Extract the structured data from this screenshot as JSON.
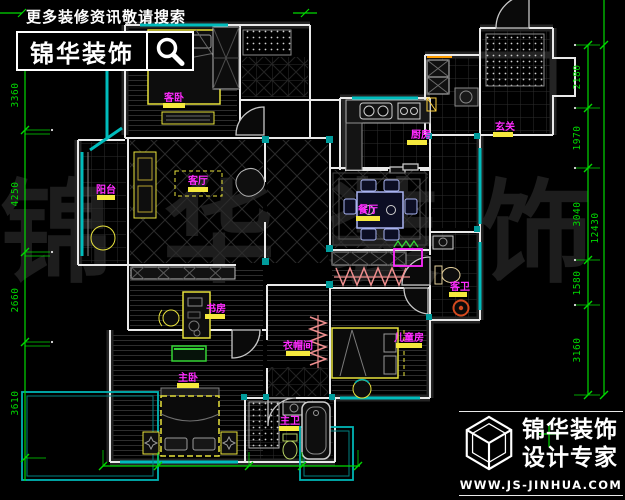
{
  "search_banner": {
    "tagline": "更多装修资讯敬请搜索",
    "brand": "锦华装饰",
    "icon": "search-icon"
  },
  "brand_footer": {
    "brand": "锦华装饰",
    "tagline": "设计专家",
    "website": "WWW.JS-JINHUA.COM",
    "icon": "cube-logo-icon"
  },
  "watermark": {
    "chars": [
      "锦",
      "华",
      "装",
      "饰"
    ]
  },
  "rooms": {
    "bedroom_top": {
      "label": "客卧"
    },
    "living": {
      "label": "客厅"
    },
    "balcony": {
      "label": "阳台"
    },
    "dining": {
      "label": "餐厅"
    },
    "kitchen": {
      "label": "厨房"
    },
    "entrance": {
      "label": "玄关"
    },
    "study": {
      "label": "书房"
    },
    "master": {
      "label": "主卧"
    },
    "closet": {
      "label": "衣帽间"
    },
    "bath_right": {
      "label": "客卫"
    },
    "bedroom_child": {
      "label": "儿童房"
    },
    "master_bath": {
      "label": "主卫"
    }
  },
  "dimensions": {
    "left": [
      "3360",
      "4250",
      "2660",
      "3610"
    ],
    "right": [
      "2180",
      "1970",
      "3040",
      "1580",
      "3160"
    ],
    "right_total": "12430"
  },
  "colors": {
    "wall": "#e9e9e9",
    "window": "#00bcbc",
    "furniture": "#e8e23c",
    "label": "#ff2bff",
    "label_bar": "#f5e93d",
    "dimension": "#00d900",
    "hanger": "#ef8f8f",
    "dining_chair": "#a9b4f2"
  }
}
